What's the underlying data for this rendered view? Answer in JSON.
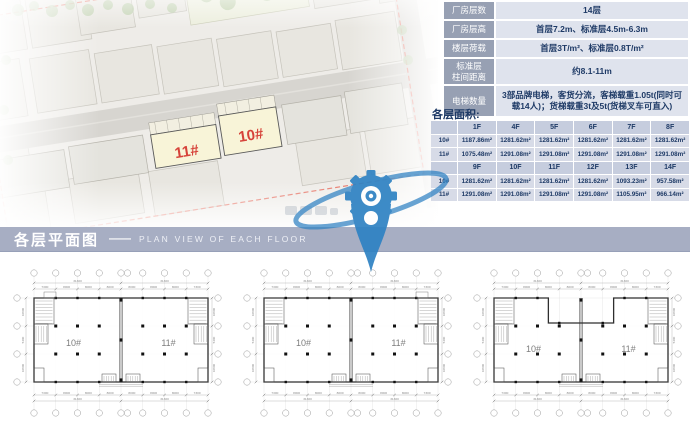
{
  "spec_table": {
    "rows": [
      {
        "label": "厂房层数",
        "value": "14层"
      },
      {
        "label": "厂房层高",
        "value": "首层7.2m、标准层4.5m-6.3m"
      },
      {
        "label": "楼层荷载",
        "value": "首层3T/m²、标准层0.8T/m²"
      },
      {
        "label": "标准层\n柱间距离",
        "value": "约8.1-11m"
      },
      {
        "label": "电梯数量",
        "value": "3部品牌电梯，客货分流，客梯载重1.05t(同时可载14人)；货梯载重3t及5t(货梯叉车可直入)"
      }
    ]
  },
  "area_section": {
    "title": "各层面积:",
    "table": {
      "header_row_indexes": [
        0,
        3
      ],
      "rows": [
        [
          "",
          "1F",
          "4F",
          "5F",
          "6F",
          "7F",
          "8F"
        ],
        [
          "10#",
          "1187.86m²",
          "1281.62m²",
          "1281.62m²",
          "1281.62m²",
          "1281.62m²",
          "1281.62m²"
        ],
        [
          "11#",
          "1075.48m²",
          "1291.08m²",
          "1291.08m²",
          "1291.08m²",
          "1291.08m²",
          "1291.08m²"
        ],
        [
          "",
          "9F",
          "10F",
          "11F",
          "12F",
          "13F",
          "14F"
        ],
        [
          "10#",
          "1281.62m²",
          "1281.62m²",
          "1281.62m²",
          "1281.62m²",
          "1093.23m²",
          "957.58m²"
        ],
        [
          "11#",
          "1291.08m²",
          "1291.08m²",
          "1291.08m²",
          "1291.08m²",
          "1105.95m²",
          "966.14m²"
        ]
      ]
    }
  },
  "banner": {
    "title": "各层平面图",
    "dash": "——",
    "subtitle": "PLAN VIEW OF EACH FLOOR"
  },
  "site_plan": {
    "building_left_label": "11#",
    "building_right_label": "10#"
  },
  "floor_plans": {
    "label_left": "10#",
    "label_right": "11#",
    "top_dims": [
      "7300",
      "8000",
      "8000",
      "8000",
      "8000",
      "8000",
      "8000",
      "7300"
    ],
    "top_totals": [
      "31300",
      "31300"
    ],
    "bottom_dims": [
      "7300",
      "8000",
      "8000",
      "8000",
      "8000",
      "8000",
      "8000",
      "7300"
    ],
    "bottom_totals": [
      "31300",
      "31300"
    ],
    "side_dims": [
      "10800",
      "5400",
      "10800"
    ]
  },
  "colors": {
    "accent_navy": "#1e3a66",
    "banner_bg": "#a7aec3",
    "red_label": "#cf2117",
    "watermark_blue": "#2e82c3",
    "spec_label_bg": "#97a0b3",
    "spec_value_bg": "#dfe3ed",
    "area_header_bg": "#c6cdde",
    "area_cell_bg": "#d7dbe7",
    "highlight_yellow": "#f7f3d2",
    "boundary_red": "#e2604f"
  }
}
